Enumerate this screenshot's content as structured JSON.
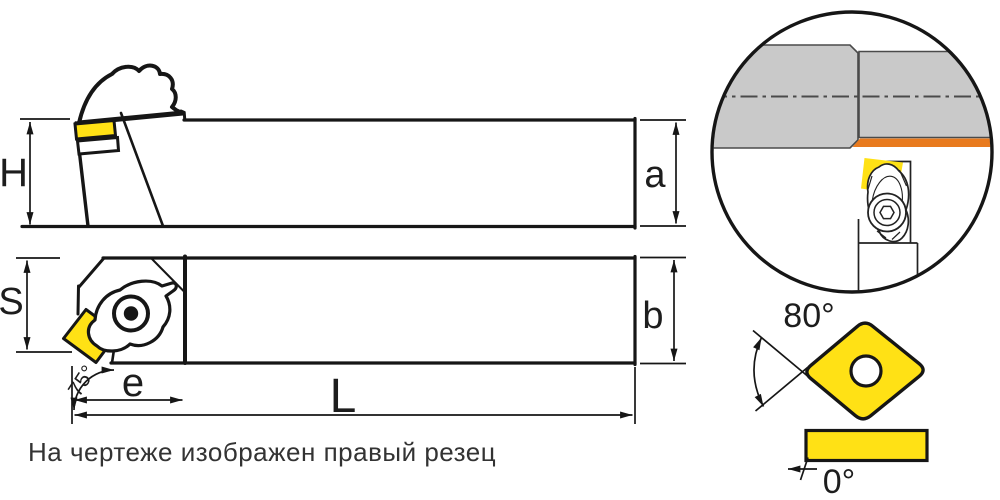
{
  "caption": "На чертеже изображен правый резец",
  "side_view": {
    "height_label": "H",
    "edge_height_label": "a"
  },
  "plan_view": {
    "width_label": "S",
    "edge_width_label": "b",
    "head_length_label": "e",
    "overall_length_label": "L",
    "lead_angle_label": "75°"
  },
  "insert_view": {
    "nose_angle_label": "80°",
    "clearance_angle_label": "0°"
  },
  "colors": {
    "insert_yellow": "#FFE115",
    "machined_surface_orange": "#E87A1E",
    "workpiece_gray": "#C9C9C9",
    "outline_black": "#161616"
  }
}
